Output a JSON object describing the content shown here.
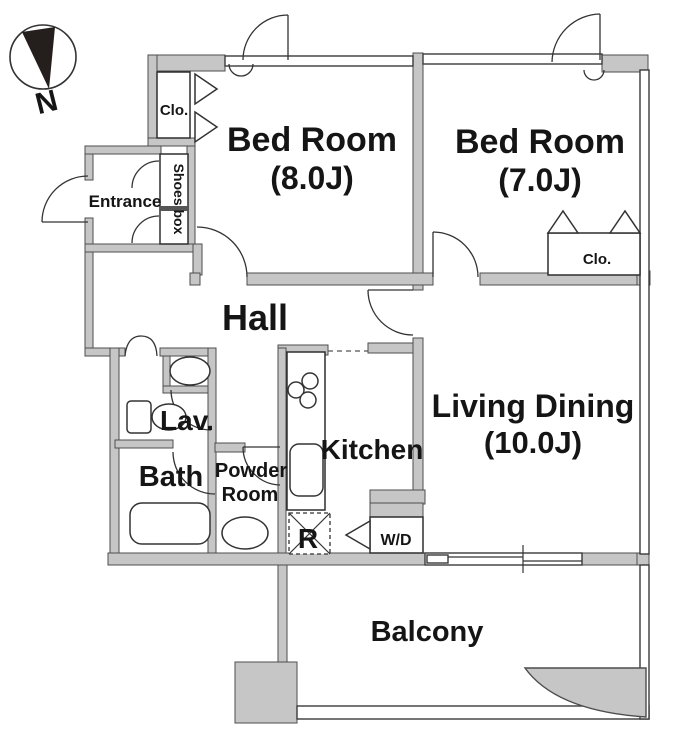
{
  "labels": {
    "north": "N",
    "closet_top": "Clo.",
    "entrance": "Entrance",
    "shoes_box": "Shoes box",
    "bedroom1_name": "Bed Room",
    "bedroom1_size": "(8.0J)",
    "bedroom2_name": "Bed Room",
    "bedroom2_size": "(7.0J)",
    "closet_bedroom2": "Clo.",
    "hall": "Hall",
    "lavatory": "Lav.",
    "bath": "Bath",
    "powder_room_line1": "Powder",
    "powder_room_line2": "Room",
    "kitchen": "Kitchen",
    "refrigerator": "R",
    "washer_dryer": "W/D",
    "living_dining_name": "Living Dining",
    "living_dining_size": "(10.0J)",
    "balcony": "Balcony"
  },
  "colors": {
    "wall_fill": "#c6c6c6",
    "wall_outline": "#4d4d4d",
    "line": "#333333",
    "text": "#151515",
    "background": "#ffffff",
    "compass_needle": "#241f1c"
  }
}
